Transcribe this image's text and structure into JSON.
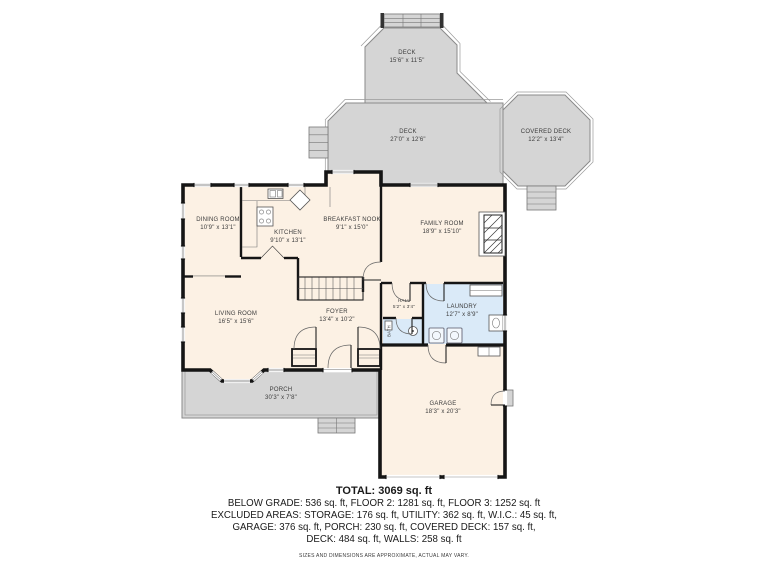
{
  "floor_plan": {
    "colors": {
      "deck": "#d5d5d5",
      "interior": "#fcf1e4",
      "laundry": "#daeaf8",
      "wall": "#151515"
    },
    "rooms": {
      "deck_top": {
        "name": "DECK",
        "dims": "15'6\" x 11'5\""
      },
      "deck_main": {
        "name": "DECK",
        "dims": "27'0\" x 12'6\""
      },
      "covered_deck": {
        "name": "COVERED DECK",
        "dims": "12'2\" x 13'4\""
      },
      "dining_room": {
        "name": "DINING ROOM",
        "dims": "10'9\" x 13'1\""
      },
      "kitchen": {
        "name": "KITCHEN",
        "dims": "9'10\" x 13'1\""
      },
      "breakfast_nook": {
        "name": "BREAKFAST NOOK",
        "dims": "9'1\" x 15'0\""
      },
      "family_room": {
        "name": "FAMILY ROOM",
        "dims": "18'9\" x 15'10\""
      },
      "living_room": {
        "name": "LIVING ROOM",
        "dims": "16'5\" x 15'6\""
      },
      "foyer": {
        "name": "FOYER",
        "dims": "13'4\" x 10'2\""
      },
      "hall": {
        "name": "HALL",
        "dims": "5'2\" x 3'4\""
      },
      "laundry": {
        "name": "LAUNDRY",
        "dims": "12'7\" x 8'9\""
      },
      "bath": {
        "name": "BATH",
        "dims": ""
      },
      "porch": {
        "name": "PORCH",
        "dims": "30'3\" x 7'8\""
      },
      "garage": {
        "name": "GARAGE",
        "dims": "18'3\" x 20'3\""
      }
    },
    "summary": {
      "total": "TOTAL: 3069 sq. ft",
      "line1": "BELOW GRADE: 536 sq. ft, FLOOR 2: 1281 sq. ft, FLOOR 3: 1252 sq. ft",
      "line2": "EXCLUDED AREAS: STORAGE: 176 sq. ft, UTILITY: 362 sq. ft, W.I.C.: 45 sq. ft,",
      "line3": "GARAGE: 376 sq. ft, PORCH: 230 sq. ft, COVERED DECK: 157 sq. ft,",
      "line4": "DECK: 484 sq. ft, WALLS: 258 sq. ft",
      "disclaimer": "SIZES AND DIMENSIONS ARE APPROXIMATE, ACTUAL MAY VARY."
    }
  }
}
